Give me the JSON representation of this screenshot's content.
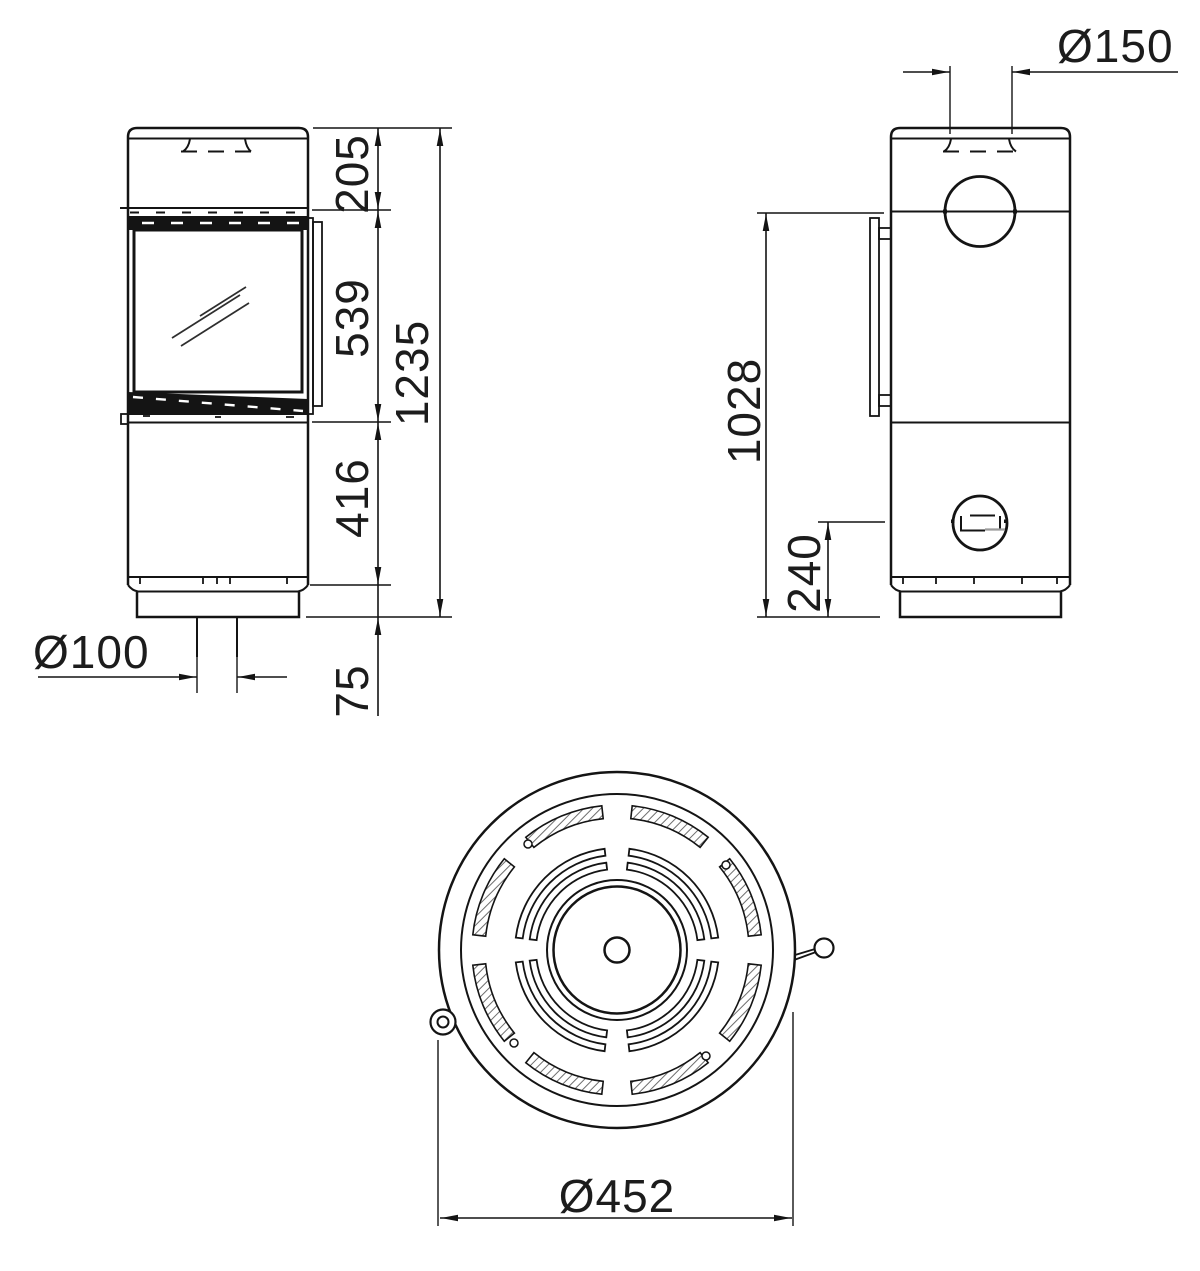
{
  "drawing": {
    "kind": "stove dimension drawing",
    "views": {
      "front": "front view",
      "side": "side view",
      "top": "top view"
    }
  },
  "dimensions": {
    "front": {
      "top_section": "205",
      "window_section": "539",
      "lower_section": "416",
      "plinth": "75",
      "total_height": "1235",
      "floor_air_inlet_diameter": "Ø100"
    },
    "side": {
      "flue_pipe_diameter": "Ø150",
      "door_top_height": "1028",
      "rear_air_inlet_height": "240"
    },
    "top": {
      "body_diameter": "Ø452"
    }
  }
}
